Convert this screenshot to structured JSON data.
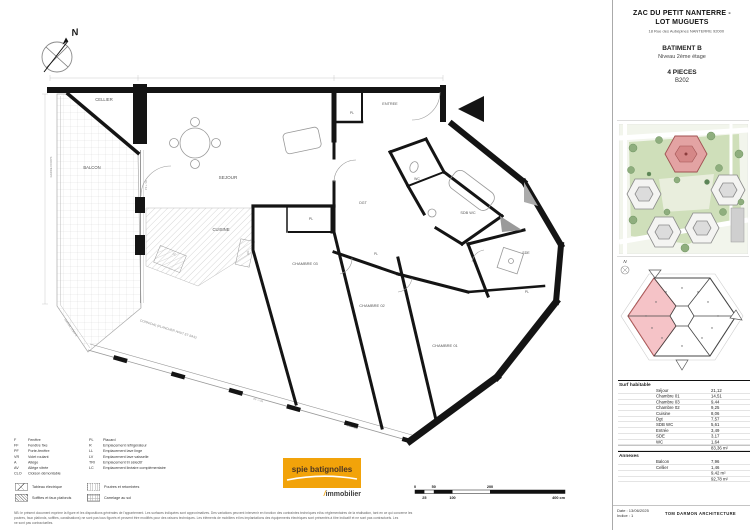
{
  "colors": {
    "logo_bg": "#F2A30A",
    "highlight_pink": "#F3B9BD",
    "wall_black": "#141414"
  },
  "sidebar": {
    "title_line1": "ZAC DU PETIT NANTERRE -",
    "title_line2": "LOT MUGUETS",
    "address": "18 Rue des Aubépines NANTERRE 92000",
    "building": "BATIMENT B",
    "level": "Niveau 2ème étage",
    "type": "4 PIECES",
    "unit": "B202",
    "surface_table": {
      "habitable_label": "Surf habitable",
      "rows": [
        {
          "room": "Séjour",
          "area": "21,12"
        },
        {
          "room": "Chambre 01",
          "area": "14,51"
        },
        {
          "room": "Chambre 03",
          "area": "9,44"
        },
        {
          "room": "Chambre 02",
          "area": "9,25"
        },
        {
          "room": "Cuisine",
          "area": "8,06"
        },
        {
          "room": "Dgt",
          "area": "7,57"
        },
        {
          "room": "SDB WC",
          "area": "5,61"
        },
        {
          "room": "Entrée",
          "area": "3,49"
        },
        {
          "room": "SDE",
          "area": "3,17"
        },
        {
          "room": "WC",
          "area": "1,64"
        }
      ],
      "habitable_total": "83,36 m²",
      "annexes_label": "Annexes",
      "annex_rows": [
        {
          "room": "Balcon",
          "area": "7,96"
        },
        {
          "room": "Cellier",
          "area": "1,46"
        }
      ],
      "annex_total": "9,42 m²",
      "grand_total": "92,78 m²"
    },
    "footer": {
      "date": "Date : 13/06/2025",
      "indice": "Indice : 1",
      "firm": "TOM DARMON ARCHITECTURE"
    }
  },
  "plan": {
    "compass_letter": "N",
    "rooms": [
      {
        "label": "CELLIER",
        "x": 104,
        "y": 101,
        "r": 0,
        "s": 4.2
      },
      {
        "label": "BALCON",
        "x": 92,
        "y": 169,
        "r": 0,
        "s": 4.2
      },
      {
        "label": "SEJOUR",
        "x": 228,
        "y": 179,
        "r": 0,
        "s": 4.6
      },
      {
        "label": "CUISINE",
        "x": 221,
        "y": 231,
        "r": 0,
        "s": 4.2
      },
      {
        "label": "ENTREE",
        "x": 390,
        "y": 105,
        "r": 0,
        "s": 3.8
      },
      {
        "label": "PL",
        "x": 352,
        "y": 114,
        "r": 0,
        "s": 3.4
      },
      {
        "label": "DGT",
        "x": 363,
        "y": 204,
        "r": 0,
        "s": 3.6
      },
      {
        "label": "WC",
        "x": 417,
        "y": 180,
        "r": 0,
        "s": 3.4
      },
      {
        "label": "SDB WC",
        "x": 468,
        "y": 214,
        "r": 0,
        "s": 3.8
      },
      {
        "label": "SDE",
        "x": 526,
        "y": 254,
        "r": 0,
        "s": 3.6
      },
      {
        "label": "PL",
        "x": 311,
        "y": 220,
        "r": 0,
        "s": 3.5
      },
      {
        "label": "CHAMBRE 03",
        "x": 305,
        "y": 265,
        "r": 0,
        "s": 4
      },
      {
        "label": "PL",
        "x": 376,
        "y": 255,
        "r": 0,
        "s": 3.2
      },
      {
        "label": "CHAMBRE 02",
        "x": 372,
        "y": 307,
        "r": 0,
        "s": 4
      },
      {
        "label": "CHAMBRE 01",
        "x": 445,
        "y": 347,
        "r": 0,
        "s": 4
      },
      {
        "label": "PL",
        "x": 527,
        "y": 293,
        "r": 0,
        "s": 3.4
      }
    ],
    "annotations": [
      {
        "label": "GARDE CORPS",
        "x": 52,
        "y": 167,
        "r": -90,
        "s": 2.8
      },
      {
        "label": "GARDE CORPS",
        "x": 70,
        "y": 328,
        "r": 56,
        "s": 2.8
      },
      {
        "label": "CORNICHE (PLANCHER HAUT ET BAS)",
        "x": 168,
        "y": 330,
        "r": 17,
        "s": 3.2
      },
      {
        "label": "PF + VR",
        "x": 147,
        "y": 185,
        "r": -90,
        "s": 2.6
      },
      {
        "label": "PF + VR",
        "x": 258,
        "y": 401,
        "r": 16,
        "s": 2.6
      },
      {
        "label": "PF + VR",
        "x": 352,
        "y": 428,
        "r": 16,
        "s": 2.6
      },
      {
        "label": "TRI",
        "x": 247,
        "y": 253,
        "r": 80,
        "s": 2.8
      },
      {
        "label": "LC",
        "x": 174,
        "y": 255,
        "r": 25,
        "s": 2.8
      }
    ]
  },
  "legend": {
    "col1": [
      {
        "key": "F",
        "label": "Fenêtre"
      },
      {
        "key": "FF",
        "label": "Fenêtre fixe"
      },
      {
        "key": "PF",
        "label": "Porte-fenêtre"
      },
      {
        "key": "VR",
        "label": "Volet roulant"
      },
      {
        "key": "A",
        "label": "Allège"
      },
      {
        "key": "AV",
        "label": "Allège vitrée"
      },
      {
        "key": "CLO",
        "label": "Cloison démontable"
      }
    ],
    "col2": [
      {
        "key": "PL",
        "label": "Placard"
      },
      {
        "key": "R",
        "label": "Emplacement réfrigérateur"
      },
      {
        "key": "LL",
        "label": "Emplacement lave linge"
      },
      {
        "key": "LV",
        "label": "Emplacement lave vaisselle"
      },
      {
        "key": "TRI",
        "label": "Emplacement tri sélectif"
      },
      {
        "key": "LC",
        "label": "Emplacement linéaire complémentaire"
      }
    ],
    "swatches": [
      {
        "label": "Tableau électrique"
      },
      {
        "label": "Poutres et retombées"
      },
      {
        "label": "Soffites et faux plafonds"
      },
      {
        "label": "Carrelage au sol"
      }
    ]
  },
  "note_lines": [
    "NB: le présent document exprime la figure et les dispositions générales de l'appartement. Les surfaces indiquées sont approximatives. Des variations peuvent intervenir en fonction des contraintes techniques et/ou réglementaires de la réalisation, tant en ce qui concerne les",
    "poutres, faux plafonds, soffites, canalisations) ne sont pas tous figurés et peuvent être modifiés pour des raisons techniques. Les éléments de mobiliers et les implantations des équipements électriques sont présentés à titre indicatif et ne sont pas contractuels. Les",
    "ne sont pas contractuelles."
  ],
  "logo": {
    "line1": "spie batignolles",
    "slash": "/",
    "line2": "immobilier"
  },
  "scale_bar": {
    "top_labels": [
      "0",
      "50",
      "200"
    ],
    "bottom_labels": [
      "25",
      "100",
      "400 cm"
    ]
  }
}
